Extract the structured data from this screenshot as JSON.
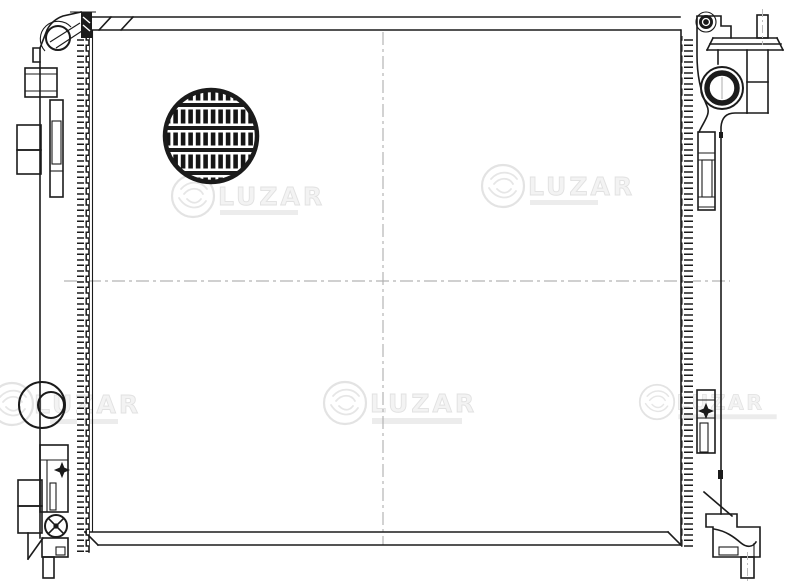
{
  "page": {
    "background": "#ffffff",
    "width": 800,
    "height": 586
  },
  "drawing": {
    "subject": "radiator",
    "style": "black-and-white technical line drawing",
    "ink_color": "#1b1b1b",
    "centerline_color": "#b3b3b3",
    "marks": {
      "diamond_position_marks": 2,
      "centerlines": "vertical and horizontal dash-dot crosshair"
    }
  },
  "watermark": {
    "text": "LUZAR",
    "color": "#e3e3e3",
    "instances": 5
  }
}
